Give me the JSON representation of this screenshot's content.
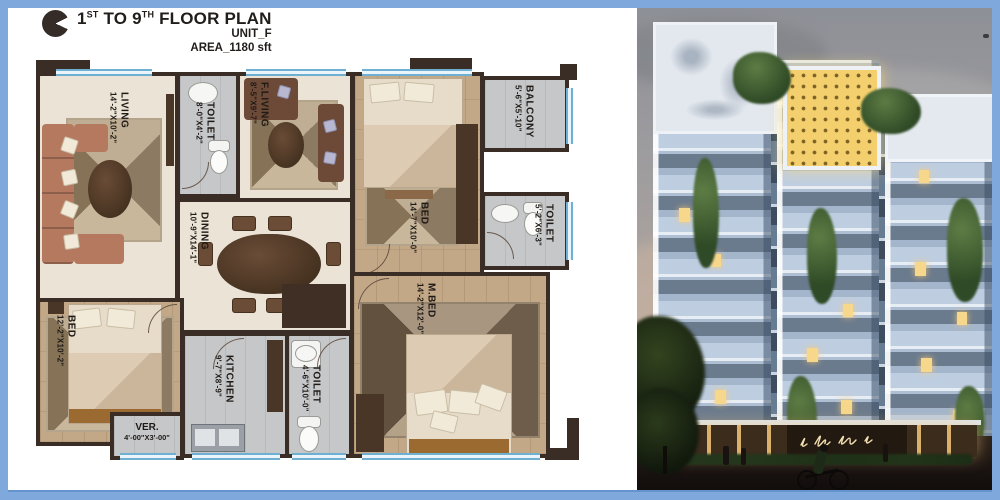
{
  "header": {
    "t1": "1",
    "s1": "ST",
    "t2": " TO 9",
    "s2": "TH",
    "t3": " FLOOR PLAN",
    "unit": "UNIT_F",
    "area": "AREA_1180 sft"
  },
  "rooms": [
    {
      "name": "LIVING",
      "dims": "14'-2\"X10'-2\""
    },
    {
      "name": "TOILET",
      "dims": "8'-0\"X4'-2\""
    },
    {
      "name": "F.LIVING",
      "dims": "8'-5\"X9'-7\""
    },
    {
      "name": "BED",
      "dims": "14'-7\"X10'-0\""
    },
    {
      "name": "BALCONY",
      "dims": "5'-6\"X5'-10\""
    },
    {
      "name": "TOILET",
      "dims": "5'-2\"X6'-3\""
    },
    {
      "name": "DINING",
      "dims": "10'-9\"X14'-1\""
    },
    {
      "name": "BED",
      "dims": "12'-2\"X10'-2\""
    },
    {
      "name": "KITCHEN",
      "dims": "9'-7\"X8'-9\""
    },
    {
      "name": "TOILET",
      "dims": "4'-6\"X10'-0\""
    },
    {
      "name": "M.BED",
      "dims": "14'-2\"X12'-0\""
    },
    {
      "name": "VER.",
      "dims": "4'-00\"X3'-00\""
    }
  ],
  "icons": {
    "logo": "quarter-notch-circle",
    "entrance_sign": "script-signature"
  },
  "colors": {
    "frame_blue": "#7fa9dc",
    "wall_brown": "#3a2d25",
    "window_blue": "#6fb0d2",
    "floor_cream": "#eae3d6",
    "floor_tan": "#c3a888",
    "floor_gray": "#c6c7c9",
    "screen_yellow": "#f3cf6d",
    "lit_window": "#f6d78c"
  }
}
